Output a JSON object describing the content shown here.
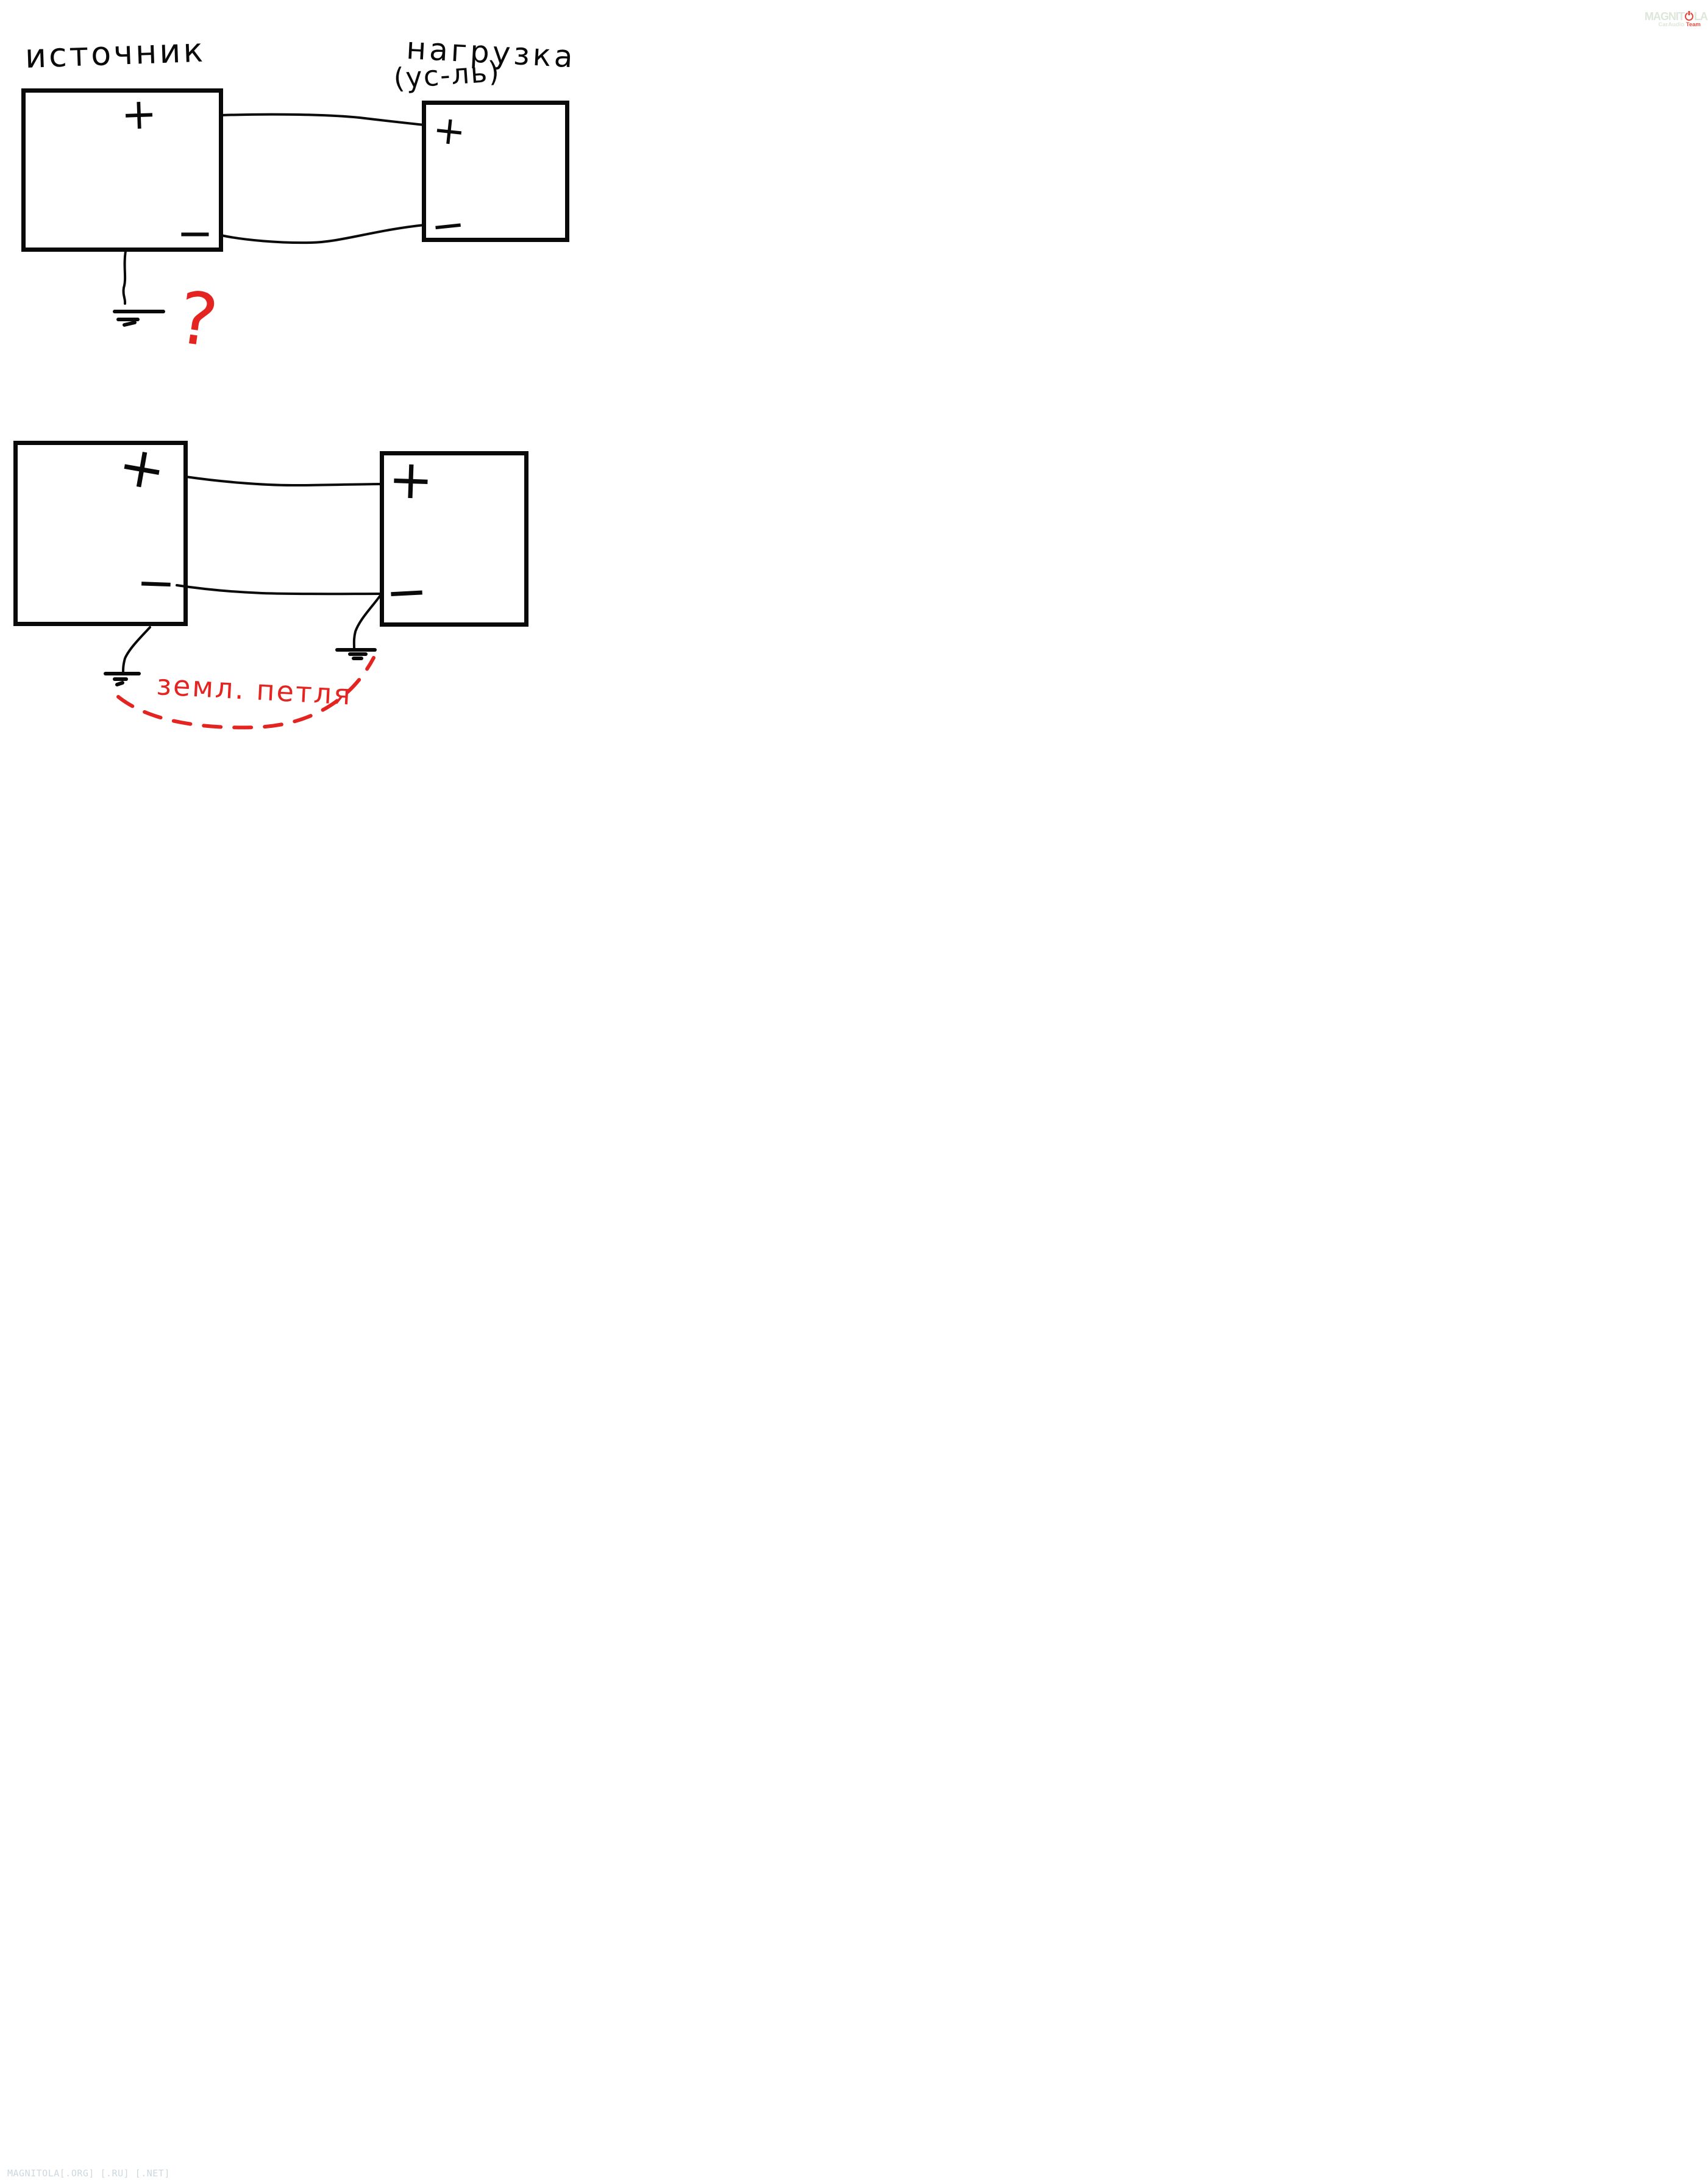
{
  "colors": {
    "ink": "#0a0a0a",
    "annotation_red": "#e32420",
    "logo_pale_green": "#dde7d9",
    "logo_red": "#e2453c",
    "footer_gray_blue": "#ccd8df",
    "background": "#ffffff"
  },
  "top_diagram": {
    "source_label": "источник",
    "load_label_line1": "нагрузка",
    "load_label_line2": "(ус-ль)",
    "source_plus": "+",
    "source_minus": "−",
    "load_plus": "+",
    "load_minus": "−",
    "question_mark": "?"
  },
  "bottom_diagram": {
    "left_plus": "+",
    "left_minus": "−",
    "right_plus": "+",
    "right_minus": "−",
    "ground_loop_label": "земл. петля"
  },
  "logo": {
    "brand_prefix": "MAGNIT",
    "brand_suffix": "LA",
    "subtitle_main": "CarAudio",
    "subtitle_accent": "Team"
  },
  "footer": {
    "watermark": "MAGNITOLA[.ORG] [.RU] [.NET]"
  }
}
